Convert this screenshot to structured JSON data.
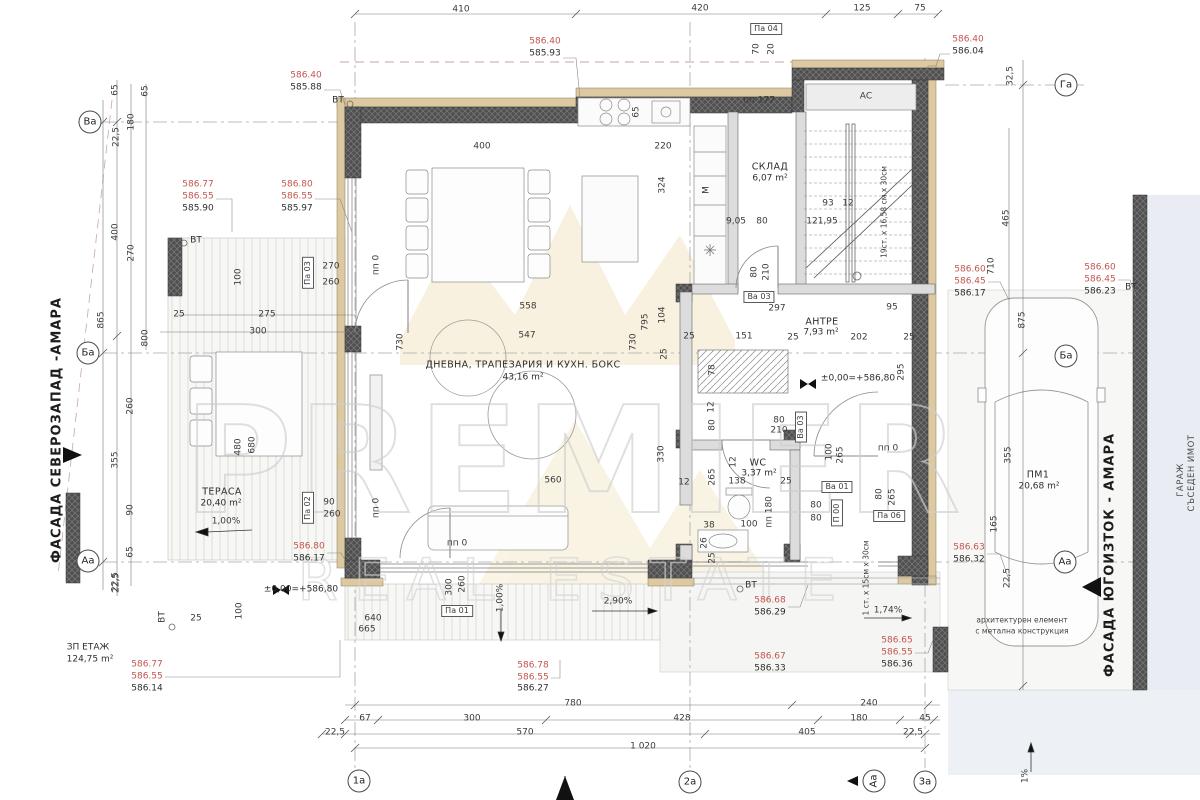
{
  "watermark": {
    "line1": "PREMIER",
    "line2": "REAL ESTATE"
  },
  "colors": {
    "elevation_upper": "#c4554e",
    "wall_fill": "#4f4f4f",
    "insulation": "#dcc9a2",
    "neighbor_fill": "#e9edf3",
    "watermark_stroke": "#d2d2d2",
    "crown_fill": "#f7ecd4"
  },
  "facades": {
    "northwest": "ФАСАДА СЕВЕРОЗАПАД -АМАРА",
    "southeast": "ФАСАДА ЮГОИЗТОК - АМАРА"
  },
  "rooms": [
    {
      "name": "ДНЕВНА, ТРАПЕЗАРИЯ И КУХН. БОКС",
      "area": "43,16 m²"
    },
    {
      "name": "СКЛАД",
      "area": "6,07 m²"
    },
    {
      "name": "АНТРЕ",
      "area": "7,93 m²"
    },
    {
      "name": "WC",
      "area": "3,37 m²"
    },
    {
      "name": "ТЕРАСА",
      "area": "20,40 m²"
    },
    {
      "name": "ПМ1",
      "area": "20,68 m²"
    },
    {
      "name": "ЗП ЕТАЖ",
      "area": "124,75 m²"
    }
  ],
  "annotations": [
    {
      "t": "410",
      "x": 461,
      "y": 10,
      "c": "dim"
    },
    {
      "t": "420",
      "x": 700,
      "y": 9,
      "c": "dim"
    },
    {
      "t": "125",
      "x": 862,
      "y": 9,
      "c": "dim"
    },
    {
      "t": "75",
      "x": 920,
      "y": 9,
      "c": "dim"
    },
    {
      "t": "Па 04",
      "x": 766,
      "y": 29,
      "c": "box"
    },
    {
      "t": "70",
      "x": 757,
      "y": 49,
      "c": "dimv"
    },
    {
      "t": "20",
      "x": 772,
      "y": 49,
      "c": "dimv"
    },
    {
      "t": "586.40",
      "x": 545,
      "y": 42,
      "c": "red"
    },
    {
      "t": "585.93",
      "x": 545,
      "y": 54,
      "c": "blk"
    },
    {
      "t": "586.40",
      "x": 306,
      "y": 76,
      "c": "red"
    },
    {
      "t": "585.88",
      "x": 306,
      "y": 88,
      "c": "blk"
    },
    {
      "t": "586.40",
      "x": 968,
      "y": 40,
      "c": "red"
    },
    {
      "t": "586.04",
      "x": 968,
      "y": 52,
      "c": "blk"
    },
    {
      "t": "Га",
      "x": 1066,
      "y": 85,
      "c": "axis"
    },
    {
      "t": "32,5",
      "x": 1011,
      "y": 76,
      "c": "dimv"
    },
    {
      "t": "ВТ",
      "x": 338,
      "y": 101,
      "c": "blk"
    },
    {
      "t": "пп 177",
      "x": 759,
      "y": 101,
      "c": "dim"
    },
    {
      "t": "АС",
      "x": 866,
      "y": 97,
      "c": "dim"
    },
    {
      "t": "65",
      "x": 637,
      "y": 112,
      "c": "dimv"
    },
    {
      "t": "65",
      "x": 116,
      "y": 90,
      "c": "dimv"
    },
    {
      "t": "65",
      "x": 146,
      "y": 91,
      "c": "dimv"
    },
    {
      "t": "180",
      "x": 132,
      "y": 122,
      "c": "dimv"
    },
    {
      "t": "22,5",
      "x": 117,
      "y": 137,
      "c": "dimv"
    },
    {
      "t": "Ва",
      "x": 90,
      "y": 122,
      "c": "axis"
    },
    {
      "t": "400",
      "x": 116,
      "y": 232,
      "c": "dimv"
    },
    {
      "t": "270",
      "x": 132,
      "y": 253,
      "c": "dimv"
    },
    {
      "t": "865",
      "x": 102,
      "y": 320,
      "c": "dimv"
    },
    {
      "t": "800",
      "x": 146,
      "y": 338,
      "c": "dimv"
    },
    {
      "t": "Ба",
      "x": 88,
      "y": 353,
      "c": "axis"
    },
    {
      "t": "260",
      "x": 131,
      "y": 406,
      "c": "dimv"
    },
    {
      "t": "355",
      "x": 116,
      "y": 460,
      "c": "dimv"
    },
    {
      "t": "90",
      "x": 131,
      "y": 510,
      "c": "dimv"
    },
    {
      "t": "65",
      "x": 131,
      "y": 552,
      "c": "dimv"
    },
    {
      "t": "22,5",
      "x": 116,
      "y": 582,
      "c": "dimv"
    },
    {
      "t": "Аа",
      "x": 88,
      "y": 561,
      "c": "axis"
    },
    {
      "t": "586.77",
      "x": 198,
      "y": 185,
      "c": "red"
    },
    {
      "t": "586.55",
      "x": 198,
      "y": 197,
      "c": "red"
    },
    {
      "t": "585.90",
      "x": 198,
      "y": 209,
      "c": "blk"
    },
    {
      "t": "ВТ",
      "x": 196,
      "y": 241,
      "c": "blk"
    },
    {
      "t": "586.80",
      "x": 297,
      "y": 185,
      "c": "red"
    },
    {
      "t": "586.55",
      "x": 297,
      "y": 197,
      "c": "red"
    },
    {
      "t": "585.97",
      "x": 297,
      "y": 209,
      "c": "blk"
    },
    {
      "t": "Па 03",
      "x": 308,
      "y": 273,
      "c": "boxv"
    },
    {
      "t": "270",
      "x": 331,
      "y": 267,
      "c": "dim"
    },
    {
      "t": "260",
      "x": 331,
      "y": 283,
      "c": "dim"
    },
    {
      "t": "100",
      "x": 239,
      "y": 277,
      "c": "dimv"
    },
    {
      "t": "25",
      "x": 179,
      "y": 315,
      "c": "dim"
    },
    {
      "t": "275",
      "x": 267,
      "y": 315,
      "c": "dim"
    },
    {
      "t": "300",
      "x": 258,
      "y": 332,
      "c": "dim"
    },
    {
      "t": "пп 0",
      "x": 377,
      "y": 265,
      "c": "dimv"
    },
    {
      "t": "730",
      "x": 401,
      "y": 342,
      "c": "dimv"
    },
    {
      "t": "558",
      "x": 528,
      "y": 307,
      "c": "dim"
    },
    {
      "t": "547",
      "x": 527,
      "y": 336,
      "c": "dim"
    },
    {
      "t": "730",
      "x": 634,
      "y": 342,
      "c": "dimv"
    },
    {
      "t": "400",
      "x": 482,
      "y": 147,
      "c": "dim"
    },
    {
      "t": "ДНЕВНА, ТРАПЕЗАРИЯ И КУХН. БОКС",
      "x": 523,
      "y": 365,
      "c": "room"
    },
    {
      "t": "43,16 m²",
      "x": 523,
      "y": 378,
      "c": "area"
    },
    {
      "t": "795",
      "x": 646,
      "y": 322,
      "c": "dimv"
    },
    {
      "t": "104",
      "x": 663,
      "y": 315,
      "c": "dimv"
    },
    {
      "t": "25",
      "x": 689,
      "y": 337,
      "c": "dim"
    },
    {
      "t": "25",
      "x": 665,
      "y": 354,
      "c": "dimv"
    },
    {
      "t": "330",
      "x": 662,
      "y": 454,
      "c": "dimv"
    },
    {
      "t": "560",
      "x": 553,
      "y": 481,
      "c": "dim"
    },
    {
      "t": "12",
      "x": 684,
      "y": 483,
      "c": "dim"
    },
    {
      "t": "220",
      "x": 663,
      "y": 147,
      "c": "dim"
    },
    {
      "t": "324",
      "x": 663,
      "y": 185,
      "c": "dimv"
    },
    {
      "t": "М",
      "x": 707,
      "y": 190,
      "c": "dimv"
    },
    {
      "t": "СКЛАД",
      "x": 770,
      "y": 167,
      "c": "room"
    },
    {
      "t": "6,07 m²",
      "x": 770,
      "y": 179,
      "c": "area"
    },
    {
      "t": "9,05",
      "x": 736,
      "y": 222,
      "c": "dim"
    },
    {
      "t": "80",
      "x": 762,
      "y": 222,
      "c": "dim"
    },
    {
      "t": "93",
      "x": 828,
      "y": 204,
      "c": "dim"
    },
    {
      "t": "12",
      "x": 848,
      "y": 204,
      "c": "dim"
    },
    {
      "t": "121,95",
      "x": 822,
      "y": 222,
      "c": "dim"
    },
    {
      "t": "19ст. х 16,58 см х 30см",
      "x": 884,
      "y": 212,
      "c": "dimvs"
    },
    {
      "t": "80",
      "x": 755,
      "y": 272,
      "c": "dimv"
    },
    {
      "t": "210",
      "x": 767,
      "y": 272,
      "c": "dimv"
    },
    {
      "t": "465",
      "x": 1007,
      "y": 218,
      "c": "dimv"
    },
    {
      "t": "710",
      "x": 992,
      "y": 266,
      "c": "dimv"
    },
    {
      "t": "586.60",
      "x": 970,
      "y": 270,
      "c": "red"
    },
    {
      "t": "586.45",
      "x": 970,
      "y": 282,
      "c": "red"
    },
    {
      "t": "586.17",
      "x": 970,
      "y": 294,
      "c": "blk"
    },
    {
      "t": "586.60",
      "x": 1100,
      "y": 268,
      "c": "red"
    },
    {
      "t": "586.45",
      "x": 1100,
      "y": 280,
      "c": "red"
    },
    {
      "t": "586.23",
      "x": 1100,
      "y": 292,
      "c": "blk"
    },
    {
      "t": "ВТ",
      "x": 1131,
      "y": 288,
      "c": "blk"
    },
    {
      "t": "875",
      "x": 1023,
      "y": 320,
      "c": "dimv"
    },
    {
      "t": "Ба",
      "x": 1066,
      "y": 356,
      "c": "axis"
    },
    {
      "t": "Ва 03",
      "x": 759,
      "y": 297,
      "c": "box"
    },
    {
      "t": "297",
      "x": 777,
      "y": 309,
      "c": "dim"
    },
    {
      "t": "95",
      "x": 892,
      "y": 308,
      "c": "dim"
    },
    {
      "t": "АНТРЕ",
      "x": 822,
      "y": 322,
      "c": "room"
    },
    {
      "t": "7,93 m²",
      "x": 821,
      "y": 333,
      "c": "area"
    },
    {
      "t": "151",
      "x": 744,
      "y": 337,
      "c": "dim"
    },
    {
      "t": "25",
      "x": 793,
      "y": 338,
      "c": "dim"
    },
    {
      "t": "202",
      "x": 859,
      "y": 338,
      "c": "dim"
    },
    {
      "t": "25",
      "x": 909,
      "y": 338,
      "c": "dim"
    },
    {
      "t": "±0,00=+586,80",
      "x": 858,
      "y": 379,
      "c": "blk"
    },
    {
      "t": "295",
      "x": 902,
      "y": 372,
      "c": "dimv"
    },
    {
      "t": "78",
      "x": 713,
      "y": 370,
      "c": "dimv"
    },
    {
      "t": "12",
      "x": 712,
      "y": 407,
      "c": "dimv"
    },
    {
      "t": "80",
      "x": 713,
      "y": 425,
      "c": "dimv"
    },
    {
      "t": "80",
      "x": 779,
      "y": 421,
      "c": "dim"
    },
    {
      "t": "210",
      "x": 779,
      "y": 431,
      "c": "dim"
    },
    {
      "t": "Ва 03",
      "x": 801,
      "y": 427,
      "c": "boxv"
    },
    {
      "t": "пп 0",
      "x": 888,
      "y": 449,
      "c": "dim"
    },
    {
      "t": "WC",
      "x": 758,
      "y": 463,
      "c": "room"
    },
    {
      "t": "3,37 m²",
      "x": 759,
      "y": 474,
      "c": "area"
    },
    {
      "t": "138",
      "x": 737,
      "y": 482,
      "c": "dim"
    },
    {
      "t": "25",
      "x": 786,
      "y": 482,
      "c": "dim"
    },
    {
      "t": "12",
      "x": 734,
      "y": 462,
      "c": "dimv"
    },
    {
      "t": "265",
      "x": 713,
      "y": 477,
      "c": "dimv"
    },
    {
      "t": "пп 180",
      "x": 770,
      "y": 512,
      "c": "dimv"
    },
    {
      "t": "38",
      "x": 709,
      "y": 526,
      "c": "dim"
    },
    {
      "t": "100",
      "x": 749,
      "y": 525,
      "c": "dim"
    },
    {
      "t": "26",
      "x": 705,
      "y": 543,
      "c": "dimv"
    },
    {
      "t": "25",
      "x": 713,
      "y": 558,
      "c": "dimv"
    },
    {
      "t": "100",
      "x": 830,
      "y": 452,
      "c": "dimv"
    },
    {
      "t": "265",
      "x": 841,
      "y": 455,
      "c": "dimv"
    },
    {
      "t": "Ва 01",
      "x": 837,
      "y": 487,
      "c": "box"
    },
    {
      "t": "80",
      "x": 816,
      "y": 506,
      "c": "dim"
    },
    {
      "t": "80",
      "x": 816,
      "y": 519,
      "c": "dim"
    },
    {
      "t": "П 00",
      "x": 837,
      "y": 513,
      "c": "boxv"
    },
    {
      "t": "Па 06",
      "x": 889,
      "y": 516,
      "c": "box"
    },
    {
      "t": "80",
      "x": 880,
      "y": 494,
      "c": "dimv"
    },
    {
      "t": "265",
      "x": 893,
      "y": 497,
      "c": "dimv"
    },
    {
      "t": "ТЕРАСА",
      "x": 222,
      "y": 492,
      "c": "room"
    },
    {
      "t": "20,40 m²",
      "x": 221,
      "y": 504,
      "c": "area"
    },
    {
      "t": "1,00%",
      "x": 226,
      "y": 522,
      "c": "dim"
    },
    {
      "t": "480",
      "x": 239,
      "y": 447,
      "c": "dimv"
    },
    {
      "t": "680",
      "x": 253,
      "y": 445,
      "c": "dimv"
    },
    {
      "t": "Па 02",
      "x": 308,
      "y": 508,
      "c": "boxv"
    },
    {
      "t": "90",
      "x": 329,
      "y": 503,
      "c": "dim"
    },
    {
      "t": "260",
      "x": 332,
      "y": 515,
      "c": "dim"
    },
    {
      "t": "пп 0",
      "x": 377,
      "y": 508,
      "c": "dimv"
    },
    {
      "t": "586.80",
      "x": 309,
      "y": 547,
      "c": "red"
    },
    {
      "t": "586.17",
      "x": 309,
      "y": 559,
      "c": "blk"
    },
    {
      "t": "пп 0",
      "x": 457,
      "y": 544,
      "c": "dim"
    },
    {
      "t": "300",
      "x": 450,
      "y": 587,
      "c": "dimv"
    },
    {
      "t": "260",
      "x": 463,
      "y": 584,
      "c": "dimv"
    },
    {
      "t": "Па 01",
      "x": 457,
      "y": 611,
      "c": "box"
    },
    {
      "t": "1,00%",
      "x": 501,
      "y": 598,
      "c": "dimv"
    },
    {
      "t": "2,90%",
      "x": 618,
      "y": 602,
      "c": "dim"
    },
    {
      "t": "640",
      "x": 373,
      "y": 619,
      "c": "dim"
    },
    {
      "t": "665",
      "x": 367,
      "y": 630,
      "c": "dim"
    },
    {
      "t": "±0,00=+586,80",
      "x": 301,
      "y": 590,
      "c": "blk"
    },
    {
      "t": "100",
      "x": 240,
      "y": 611,
      "c": "dimv"
    },
    {
      "t": "22,5",
      "x": 117,
      "y": 583,
      "c": "dimv"
    },
    {
      "t": "ВТ",
      "x": 163,
      "y": 617,
      "c": "dimv"
    },
    {
      "t": "25",
      "x": 196,
      "y": 619,
      "c": "dim"
    },
    {
      "t": "ЗП ЕТАЖ",
      "x": 88,
      "y": 648,
      "c": "blk"
    },
    {
      "t": "124,75 m²",
      "x": 90,
      "y": 660,
      "c": "blk"
    },
    {
      "t": "586.77",
      "x": 147,
      "y": 665,
      "c": "red"
    },
    {
      "t": "586.55",
      "x": 147,
      "y": 677,
      "c": "red"
    },
    {
      "t": "586.14",
      "x": 147,
      "y": 689,
      "c": "blk"
    },
    {
      "t": "586.68",
      "x": 770,
      "y": 601,
      "c": "red"
    },
    {
      "t": "586.29",
      "x": 770,
      "y": 613,
      "c": "blk"
    },
    {
      "t": "ВТ",
      "x": 751,
      "y": 586,
      "c": "blk"
    },
    {
      "t": "1 ст. х 15см х 30см",
      "x": 866,
      "y": 578,
      "c": "dimvs"
    },
    {
      "t": "1,74%",
      "x": 888,
      "y": 611,
      "c": "dim"
    },
    {
      "t": "586.67",
      "x": 770,
      "y": 657,
      "c": "red"
    },
    {
      "t": "586.33",
      "x": 770,
      "y": 669,
      "c": "blk"
    },
    {
      "t": "586.65",
      "x": 897,
      "y": 641,
      "c": "red"
    },
    {
      "t": "586.55",
      "x": 897,
      "y": 653,
      "c": "red"
    },
    {
      "t": "586.36",
      "x": 897,
      "y": 665,
      "c": "blk"
    },
    {
      "t": "архитектурен елемент",
      "x": 1022,
      "y": 620,
      "c": "note"
    },
    {
      "t": "с метална конструкция",
      "x": 1022,
      "y": 631,
      "c": "note"
    },
    {
      "t": "586.78",
      "x": 533,
      "y": 666,
      "c": "red"
    },
    {
      "t": "586.55",
      "x": 533,
      "y": 678,
      "c": "red"
    },
    {
      "t": "586.27",
      "x": 533,
      "y": 689,
      "c": "blk"
    },
    {
      "t": "780",
      "x": 573,
      "y": 704,
      "c": "dim"
    },
    {
      "t": "67",
      "x": 365,
      "y": 719,
      "c": "dim"
    },
    {
      "t": "300",
      "x": 472,
      "y": 719,
      "c": "dim"
    },
    {
      "t": "428",
      "x": 682,
      "y": 719,
      "c": "dim"
    },
    {
      "t": "240",
      "x": 869,
      "y": 704,
      "c": "dim"
    },
    {
      "t": "180",
      "x": 859,
      "y": 719,
      "c": "dim"
    },
    {
      "t": "45",
      "x": 925,
      "y": 719,
      "c": "dim"
    },
    {
      "t": "22,5",
      "x": 335,
      "y": 733,
      "c": "dim"
    },
    {
      "t": "570",
      "x": 525,
      "y": 733,
      "c": "dim"
    },
    {
      "t": "405",
      "x": 807,
      "y": 733,
      "c": "dim"
    },
    {
      "t": "22,5",
      "x": 913,
      "y": 733,
      "c": "dim"
    },
    {
      "t": "1 020",
      "x": 643,
      "y": 747,
      "c": "dim"
    },
    {
      "t": "1а",
      "x": 359,
      "y": 781,
      "c": "axis"
    },
    {
      "t": "2а",
      "x": 690,
      "y": 782,
      "c": "axis"
    },
    {
      "t": "3а",
      "x": 925,
      "y": 782,
      "c": "axis"
    },
    {
      "t": "Аа",
      "x": 874,
      "y": 781,
      "c": "axisv"
    },
    {
      "t": "ПМ1",
      "x": 1038,
      "y": 475,
      "c": "room"
    },
    {
      "t": "20,68 m²",
      "x": 1039,
      "y": 487,
      "c": "area"
    },
    {
      "t": "355",
      "x": 1009,
      "y": 455,
      "c": "dimv"
    },
    {
      "t": "165",
      "x": 995,
      "y": 524,
      "c": "dimv"
    },
    {
      "t": "22,5",
      "x": 1008,
      "y": 578,
      "c": "dimv"
    },
    {
      "t": "Аа",
      "x": 1065,
      "y": 562,
      "c": "axis"
    },
    {
      "t": "586.63",
      "x": 969,
      "y": 548,
      "c": "red"
    },
    {
      "t": "586.32",
      "x": 969,
      "y": 560,
      "c": "blk"
    },
    {
      "t": "1%",
      "x": 1026,
      "y": 776,
      "c": "dimv"
    },
    {
      "t": "ФАСАДА СЕВЕРОЗАПАД -АМАРА",
      "x": 57,
      "y": 430,
      "c": "vtext"
    },
    {
      "t": "ФАСАДА ЮГОИЗТОК - АМАРА",
      "x": 1110,
      "y": 555,
      "c": "vtext"
    },
    {
      "t": "ГАРАЖ",
      "x": 1181,
      "y": 480,
      "c": "vtextsm"
    },
    {
      "t": "СЪСЕДЕН ИМОТ",
      "x": 1192,
      "y": 473,
      "c": "vtextsm"
    }
  ]
}
